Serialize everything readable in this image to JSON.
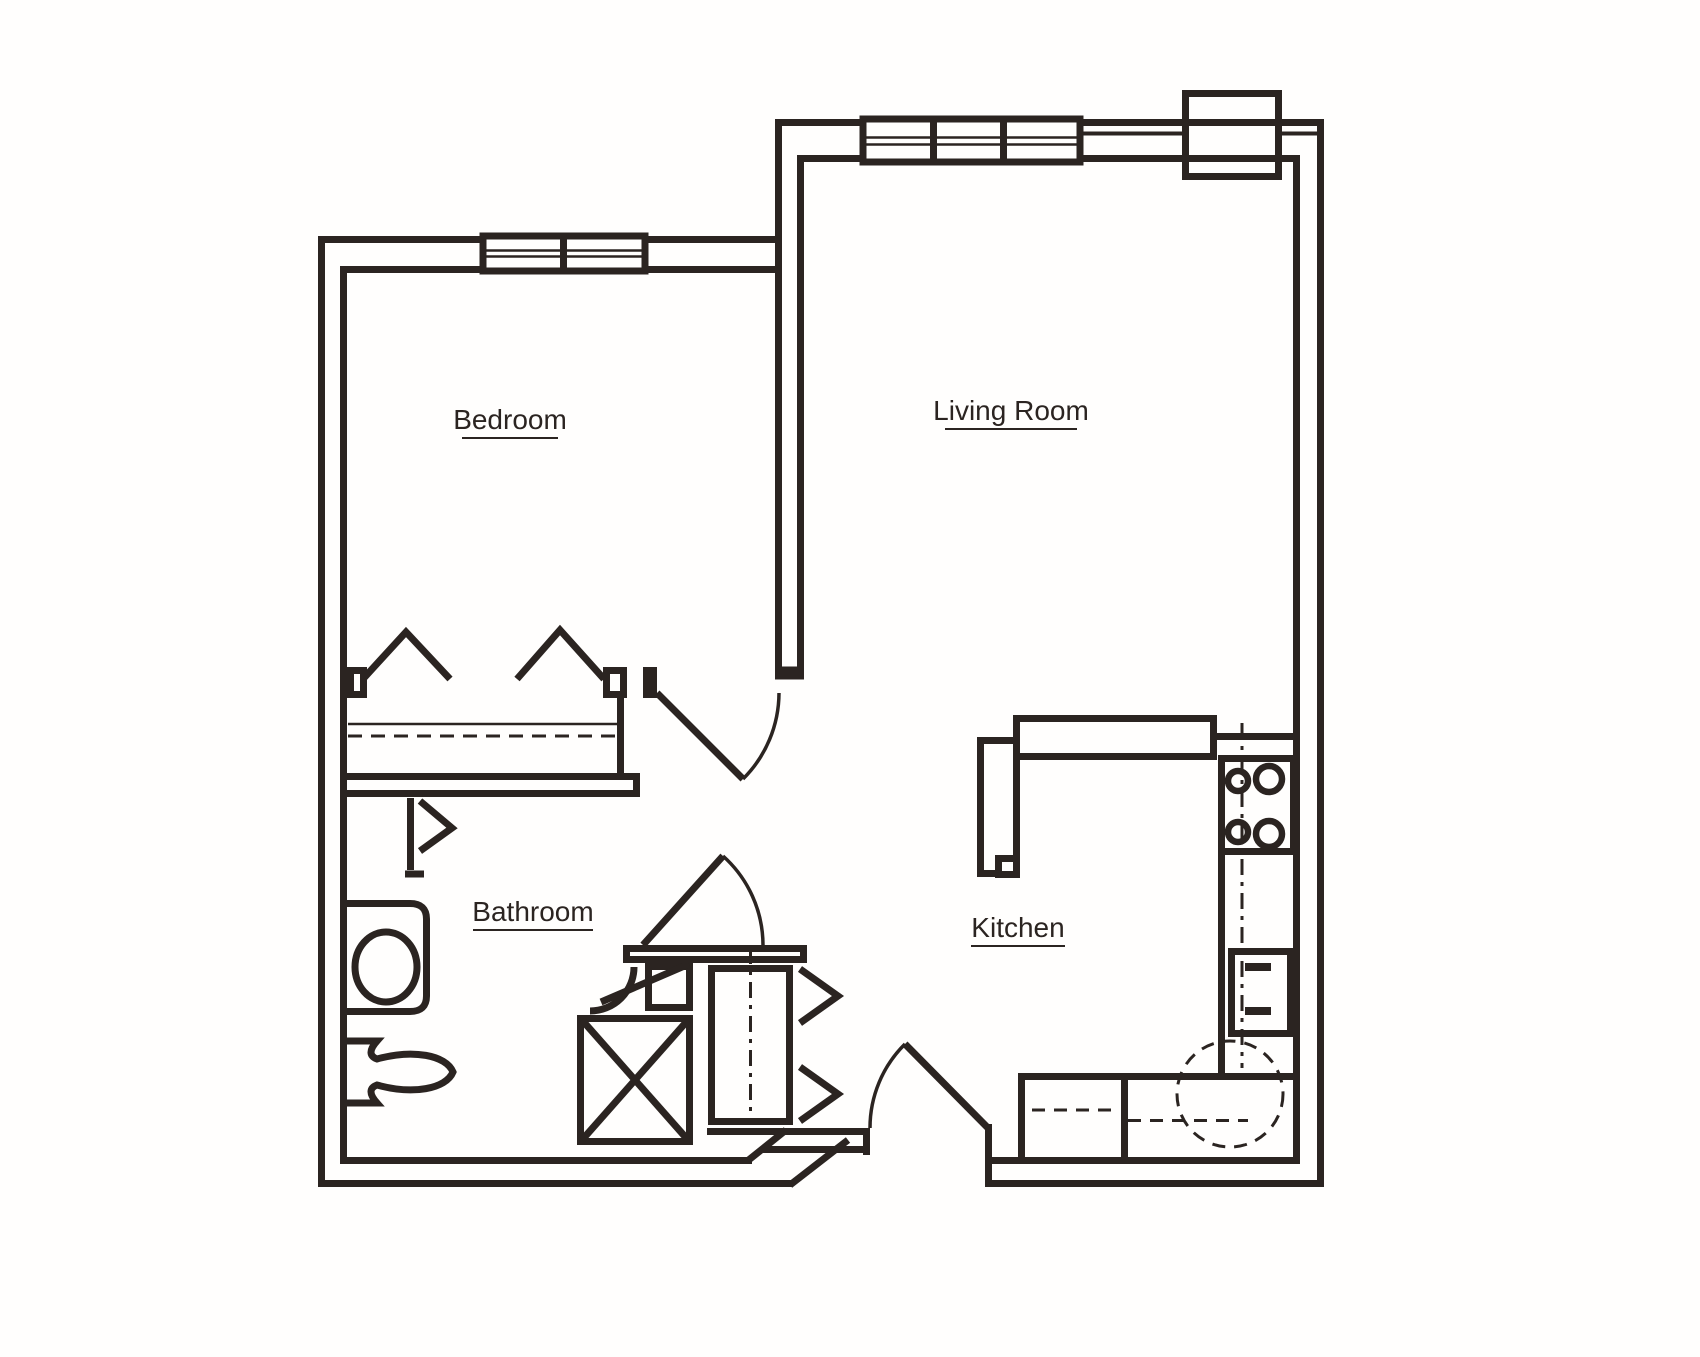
{
  "title": "One-bedroom apartment floor plan",
  "colors": {
    "ink": "#2b2421",
    "background": "#fffefd"
  },
  "rooms": [
    {
      "id": "bedroom",
      "label": "Bedroom"
    },
    {
      "id": "living-room",
      "label": "Living Room"
    },
    {
      "id": "bathroom",
      "label": "Bathroom"
    },
    {
      "id": "kitchen",
      "label": "Kitchen"
    }
  ],
  "fixtures": [
    "bedroom-window",
    "living-room-window",
    "chimney-chase",
    "bedroom-closet-bifold-doors",
    "closet-shelf",
    "closet-rod",
    "bedroom-door",
    "bathroom-door",
    "entry-door",
    "linen-closet",
    "vanity-sink",
    "toilet",
    "shower",
    "corner-basin",
    "water-heater-closet",
    "hall-closet-bifold-doors",
    "kitchen-peninsula-counter",
    "range-cooktop",
    "kitchen-sink",
    "base-cabinets",
    "kitchen-clearance-circle"
  ]
}
